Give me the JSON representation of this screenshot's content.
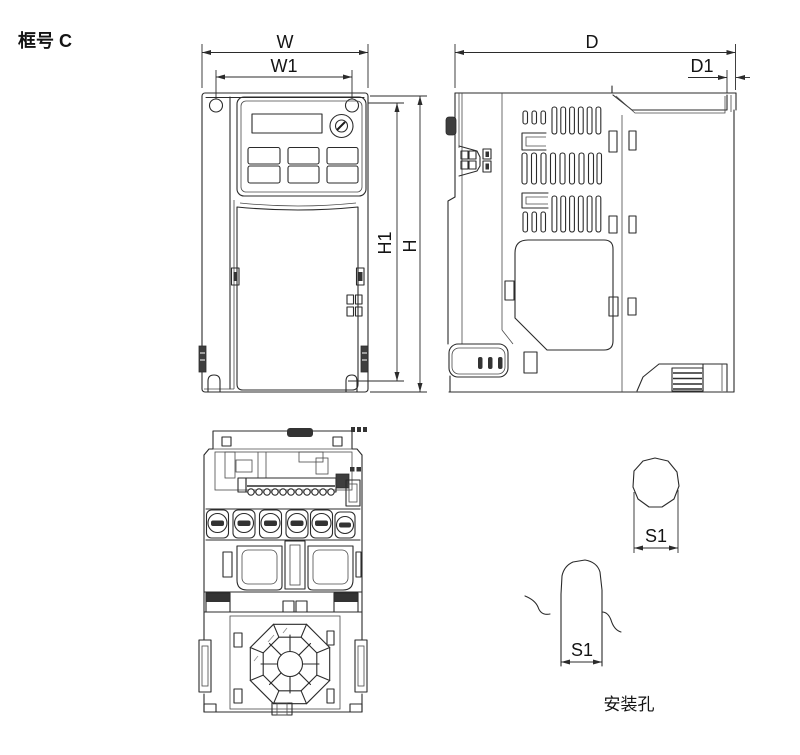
{
  "drawing": {
    "frame_label": "框号 C",
    "colors": {
      "line": "#2b2b2b",
      "background": "#ffffff",
      "dark_fill": "#333333"
    },
    "front_view": {
      "dim_width": "W",
      "dim_width_inner": "W1",
      "dim_height": "H",
      "dim_height_inner": "H1"
    },
    "side_view": {
      "dim_depth": "D",
      "dim_depth_plate": "D1"
    },
    "details": {
      "hole_top_dim": "S1",
      "hole_slot_dim": "S1",
      "caption": "安装孔"
    }
  }
}
